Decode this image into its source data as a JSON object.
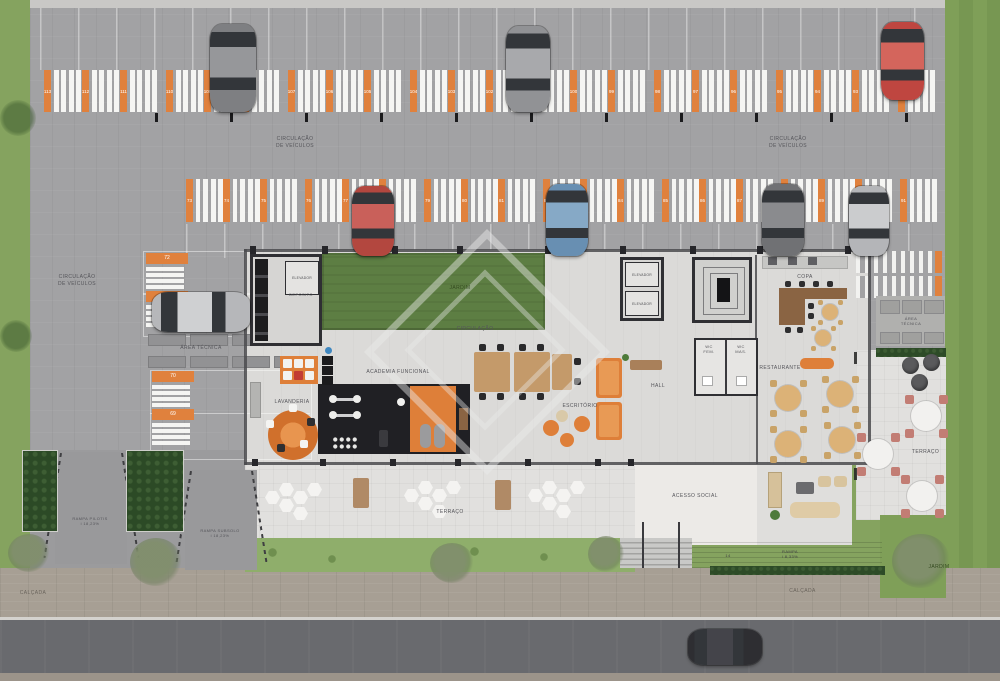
{
  "title": "Planta humanizada do pavimento térreo",
  "colors": {
    "accent_orange": "#E0813D",
    "garage_gray": "#A2A2A4",
    "floor_light": "#DBDAD8",
    "grass_green": "#85A35F",
    "jardim_green": "#5D7E43",
    "hedge_green": "#2D4B27",
    "gym_black": "#202024",
    "street_gray": "#696A6E",
    "sidewalk_tan": "#A79F94",
    "wall_dark": "#2F2F33"
  },
  "labels": {
    "circ_veiculos_l1": "CIRCULAÇÃO",
    "circ_veiculos_l2": "DE VEÍCULOS",
    "circulacao": "CIRCULAÇÃO",
    "jardim": "JARDIM",
    "elevador": "ELEVADOR",
    "deposito": "DEPOSITO",
    "copa": "COPA",
    "area_tecnica": "ÁREA TÉCNICA",
    "area_tecnica_l1": "ÁREA",
    "area_tecnica_l2": "TÉCNICA",
    "lavanderia": "LAVANDERIA",
    "academia": "ACADEMIA FUNCIONAL",
    "escritorio": "ESCRITÓRIO",
    "hall": "HALL",
    "wc_fem_l1": "WC",
    "wc_fem_l2": "FEM.",
    "wc_mas_l1": "WC",
    "wc_mas_l2": "MAS.",
    "restaurante": "RESTAURANTE",
    "terraco": "TERRAÇO",
    "acesso_social": "ACESSO SOCIAL",
    "rampa_pilotis_l1": "RAMPA PILOTIS",
    "rampa_pilotis_l2": "i 18,23%",
    "rampa_subsolo_l1": "RAMPA SUBSOLO",
    "rampa_subsolo_l2": "i 18,23%",
    "rampa_l1": "RAMPA",
    "rampa_l2": "i 8,33%",
    "steps": "14",
    "calcada": "CALÇADA"
  },
  "parking": {
    "top_row": [
      "113",
      "112",
      "111",
      "110",
      "109",
      "108",
      "107",
      "106",
      "105",
      "104",
      "103",
      "102",
      "101",
      "100",
      "99",
      "98",
      "97",
      "96",
      "95",
      "94",
      "93",
      "92"
    ],
    "middle_row": [
      "73",
      "74",
      "75",
      "76",
      "77",
      "78",
      "79",
      "80",
      "81",
      "82",
      "83",
      "84",
      "85",
      "86",
      "87",
      "88",
      "89",
      "90",
      "91"
    ],
    "left_column": [
      "72",
      "71",
      "70",
      "69"
    ]
  },
  "scene": {
    "cars": [
      {
        "x": 210,
        "y": 24,
        "w": 46,
        "h": 88,
        "dir": "v",
        "body": "#7e7f82",
        "roof": "#96979a"
      },
      {
        "x": 506,
        "y": 26,
        "w": 44,
        "h": 86,
        "dir": "v",
        "body": "#919295",
        "roof": "#a8a9ac"
      },
      {
        "x": 881,
        "y": 22,
        "w": 43,
        "h": 78,
        "dir": "v",
        "body": "#bf4640",
        "roof": "#d4655c"
      },
      {
        "x": 352,
        "y": 186,
        "w": 42,
        "h": 70,
        "dir": "v",
        "body": "#b3473f",
        "roof": "#c9605a"
      },
      {
        "x": 546,
        "y": 184,
        "w": 42,
        "h": 72,
        "dir": "v",
        "body": "#688fb2",
        "roof": "#86a9c6"
      },
      {
        "x": 762,
        "y": 184,
        "w": 42,
        "h": 72,
        "dir": "v",
        "body": "#707174",
        "roof": "#8a8b8e"
      },
      {
        "x": 849,
        "y": 186,
        "w": 40,
        "h": 70,
        "dir": "v",
        "body": "#b4b5b8",
        "roof": "#cbccce"
      },
      {
        "x": 152,
        "y": 292,
        "w": 98,
        "h": 40,
        "dir": "h",
        "body": "#b6b7ba",
        "roof": "#cfd0d2"
      },
      {
        "x": 688,
        "y": 629,
        "w": 74,
        "h": 36,
        "dir": "h",
        "body": "#2e2e32",
        "roof": "#44444a"
      }
    ],
    "copa_tables": [
      {
        "x": 830,
        "y": 312
      },
      {
        "x": 823,
        "y": 338
      }
    ],
    "restaurant_tables": [
      {
        "x": 788,
        "y": 398
      },
      {
        "x": 840,
        "y": 394
      },
      {
        "x": 788,
        "y": 444
      },
      {
        "x": 842,
        "y": 440
      }
    ],
    "terrace_tables": [
      {
        "x": 926,
        "y": 416
      },
      {
        "x": 878,
        "y": 454
      },
      {
        "x": 922,
        "y": 496
      }
    ],
    "poufs": [
      {
        "x": 910,
        "y": 365
      },
      {
        "x": 931,
        "y": 362
      },
      {
        "x": 919,
        "y": 382
      }
    ],
    "hex_clusters": [
      {
        "x": 293,
        "y": 497
      },
      {
        "x": 432,
        "y": 495
      },
      {
        "x": 556,
        "y": 495
      }
    ],
    "terrace_benches": [
      {
        "x": 353,
        "y": 478
      },
      {
        "x": 495,
        "y": 480
      }
    ]
  }
}
